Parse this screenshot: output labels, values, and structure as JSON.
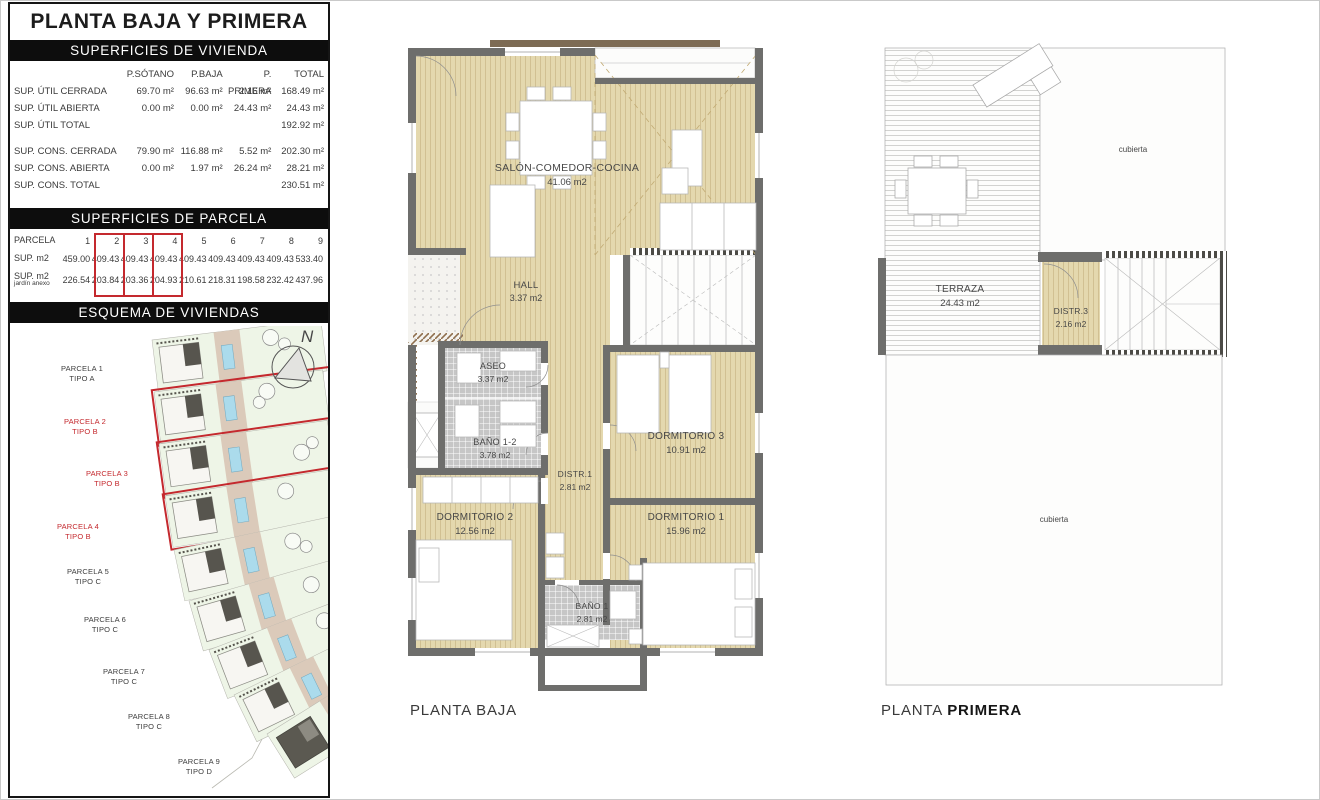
{
  "panel": {
    "title": "PLANTA BAJA Y PRIMERA",
    "vivienda": {
      "header": "SUPERFICIES DE VIVIENDA",
      "columns": [
        "P.SÓTANO",
        "P.BAJA",
        "P. PRIMERA",
        "TOTAL"
      ],
      "rows": [
        {
          "label": "SUP. ÚTIL CERRADA",
          "c1": "69.70 m²",
          "c2": "96.63 m²",
          "c3": "2.16 m²",
          "c4": "168.49 m²"
        },
        {
          "label": "SUP. ÚTIL ABIERTA",
          "c1": "0.00 m²",
          "c2": "0.00 m²",
          "c3": "24.43 m²",
          "c4": "24.43 m²"
        },
        {
          "label": "SUP. ÚTIL TOTAL",
          "c1": "",
          "c2": "",
          "c3": "",
          "c4": "192.92 m²"
        },
        {
          "label": "SUP. CONS.  CERRADA",
          "c1": "79.90 m²",
          "c2": "116.88 m²",
          "c3": "5.52 m²",
          "c4": "202.30 m²"
        },
        {
          "label": "SUP. CONS.  ABIERTA",
          "c1": "0.00 m²",
          "c2": "1.97 m²",
          "c3": "26.24 m²",
          "c4": "28.21 m²"
        },
        {
          "label": "SUP. CONS.  TOTAL",
          "c1": "",
          "c2": "",
          "c3": "",
          "c4": "230.51 m²"
        }
      ]
    },
    "parcela": {
      "header": "SUPERFICIES DE PARCELA",
      "label_parcela": "PARCELA",
      "label_sup": "SUP. m2",
      "label_jardin": "SUP. m2",
      "label_jardin2": "jardín anexo",
      "numbers": [
        "1",
        "2",
        "3",
        "4",
        "5",
        "6",
        "7",
        "8",
        "9"
      ],
      "sup": [
        "459.00",
        "409.43",
        "409.43",
        "409.43",
        "409.43",
        "409.43",
        "409.43",
        "409.43",
        "533.40"
      ],
      "jardin": [
        "226.54",
        "203.84",
        "203.36",
        "204.93",
        "210.61",
        "218.31",
        "198.58",
        "232.42",
        "437.96"
      ]
    },
    "esquema": {
      "header": "ESQUEMA DE VIVIENDAS",
      "compass_label": "N",
      "parcels": [
        {
          "name": "PARCELA 1",
          "tipo": "TIPO A"
        },
        {
          "name": "PARCELA 2",
          "tipo": "TIPO B"
        },
        {
          "name": "PARCELA 3",
          "tipo": "TIPO B"
        },
        {
          "name": "PARCELA 4",
          "tipo": "TIPO B"
        },
        {
          "name": "PARCELA 5",
          "tipo": "TIPO C"
        },
        {
          "name": "PARCELA 6",
          "tipo": "TIPO C"
        },
        {
          "name": "PARCELA 7",
          "tipo": "TIPO C"
        },
        {
          "name": "PARCELA 8",
          "tipo": "TIPO C"
        },
        {
          "name": "PARCELA 9",
          "tipo": "TIPO D"
        }
      ]
    }
  },
  "planta_baja": {
    "caption": "PLANTA BAJA",
    "rooms": {
      "salon": {
        "name": "SALÓN-COMEDOR-COCINA",
        "area": "41.06 m2"
      },
      "hall": {
        "name": "HALL",
        "area": "3.37 m2"
      },
      "aseo": {
        "name": "ASEO",
        "area": "3.37 m2"
      },
      "bano12": {
        "name": "BAÑO 1-2",
        "area": "3.78 m2"
      },
      "distr1": {
        "name": "DISTR.1",
        "area": "2.81 m2"
      },
      "dorm3": {
        "name": "DORMITORIO 3",
        "area": "10.91 m2"
      },
      "dorm2": {
        "name": "DORMITORIO 2",
        "area": "12.56 m2"
      },
      "dorm1": {
        "name": "DORMITORIO 1",
        "area": "15.96 m2"
      },
      "bano1": {
        "name": "BAÑO 1",
        "area": "2.81 m2"
      }
    }
  },
  "planta_primera": {
    "caption_plain": "PLANTA ",
    "caption_strong": "PRIMERA",
    "cubierta_top": "cubierta",
    "cubierta_bottom": "cubierta",
    "rooms": {
      "terraza": {
        "name": "TERRAZA",
        "area": "24.43 m2"
      },
      "distr3": {
        "name": "DISTR.3",
        "area": "2.16 m2"
      }
    }
  },
  "colors": {
    "accent_red": "#c4292e",
    "wall_gray": "#6e6e6c",
    "wood_floor": "#e4d8ae",
    "beam_brown": "#7d6b54",
    "pool_blue": "#abdbec",
    "lawn_green": "#eef5e7"
  }
}
